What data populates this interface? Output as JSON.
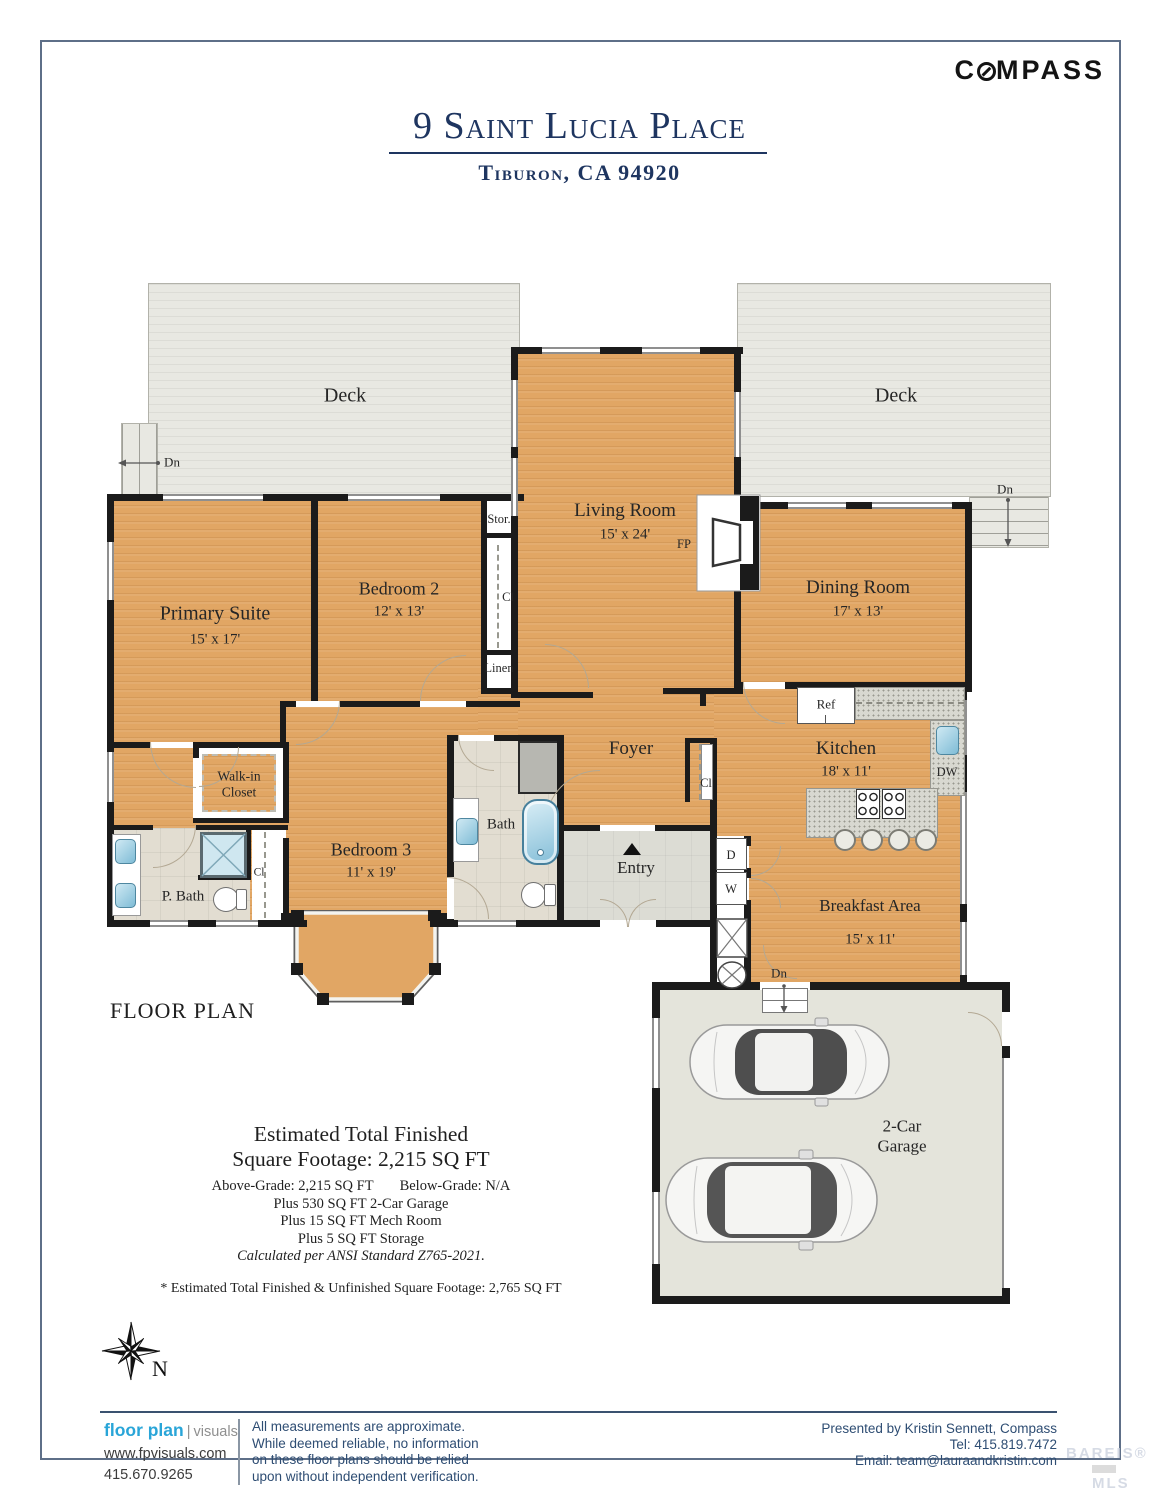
{
  "page": {
    "title": "9 Saint Lucia Place",
    "subtitle": "Tiburon, CA 94920",
    "logo_c": "C",
    "logo_rest": "MPASS",
    "floor_plan": "FLOOR PLAN",
    "north": "N"
  },
  "rooms": {
    "deck_left": {
      "name": "Deck"
    },
    "deck_right": {
      "name": "Deck"
    },
    "living": {
      "name": "Living Room",
      "dims": "15' x 24'"
    },
    "dining": {
      "name": "Dining Room",
      "dims": "17' x 13'"
    },
    "primary": {
      "name": "Primary Suite",
      "dims": "15' x 17'"
    },
    "bedroom2": {
      "name": "Bedroom 2",
      "dims": "12' x 13'"
    },
    "bedroom3": {
      "name": "Bedroom 3",
      "dims": "11' x 19'"
    },
    "kitchen": {
      "name": "Kitchen",
      "dims": "18' x 11'"
    },
    "breakfast": {
      "name": "Breakfast Area",
      "dims": "15' x 11'"
    },
    "foyer": {
      "name": "Foyer"
    },
    "entry": {
      "name": "Entry"
    },
    "bath": {
      "name": "Bath"
    },
    "pbath": {
      "name": "P. Bath"
    },
    "walkin": {
      "name": "Walk-in Closet"
    },
    "garage": {
      "name": "2-Car Garage"
    }
  },
  "annotations": {
    "dn": "Dn",
    "fp": "FP",
    "ref": "Ref",
    "dw": "DW",
    "stor": "Stor.",
    "cl": "Cl",
    "linen": "Linen",
    "d": "D",
    "w": "W"
  },
  "sqft": {
    "title1": "Estimated Total Finished",
    "title2": "Square Footage: 2,215 SQ FT",
    "above": "Above-Grade: 2,215 SQ FT",
    "below": "Below-Grade: N/A",
    "l4": "Plus 530 SQ FT 2-Car Garage",
    "l5": "Plus 15 SQ FT Mech Room",
    "l6": "Plus 5 SQ FT Storage",
    "l7": "Calculated per ANSI Standard Z765-2021.",
    "footnote": "* Estimated Total Finished & Unfinished Square Footage: 2,765 SQ FT"
  },
  "footer": {
    "brand_bold": "floor plan",
    "brand_light": "visuals",
    "website": "www.fpvisuals.com",
    "phone": "415.670.9265",
    "disc1": "All measurements are approximate.",
    "disc2": "While deemed reliable, no information",
    "disc3": "on these floor plans should be relied",
    "disc4": "upon without independent verification.",
    "presented": "Presented by Kristin Sennett, Compass",
    "tel": "Tel: 415.819.7472",
    "email": "Email: team@lauraandkristin.com",
    "watermark1": "BAREIS®",
    "watermark2": "MLS"
  },
  "colors": {
    "navy": "#1e3560",
    "wall": "#1b1b1b",
    "wood": "#e1a664",
    "deck": "#e8e8e2",
    "brand_blue": "#29a5d8",
    "footer_navy": "#2e4d73"
  }
}
